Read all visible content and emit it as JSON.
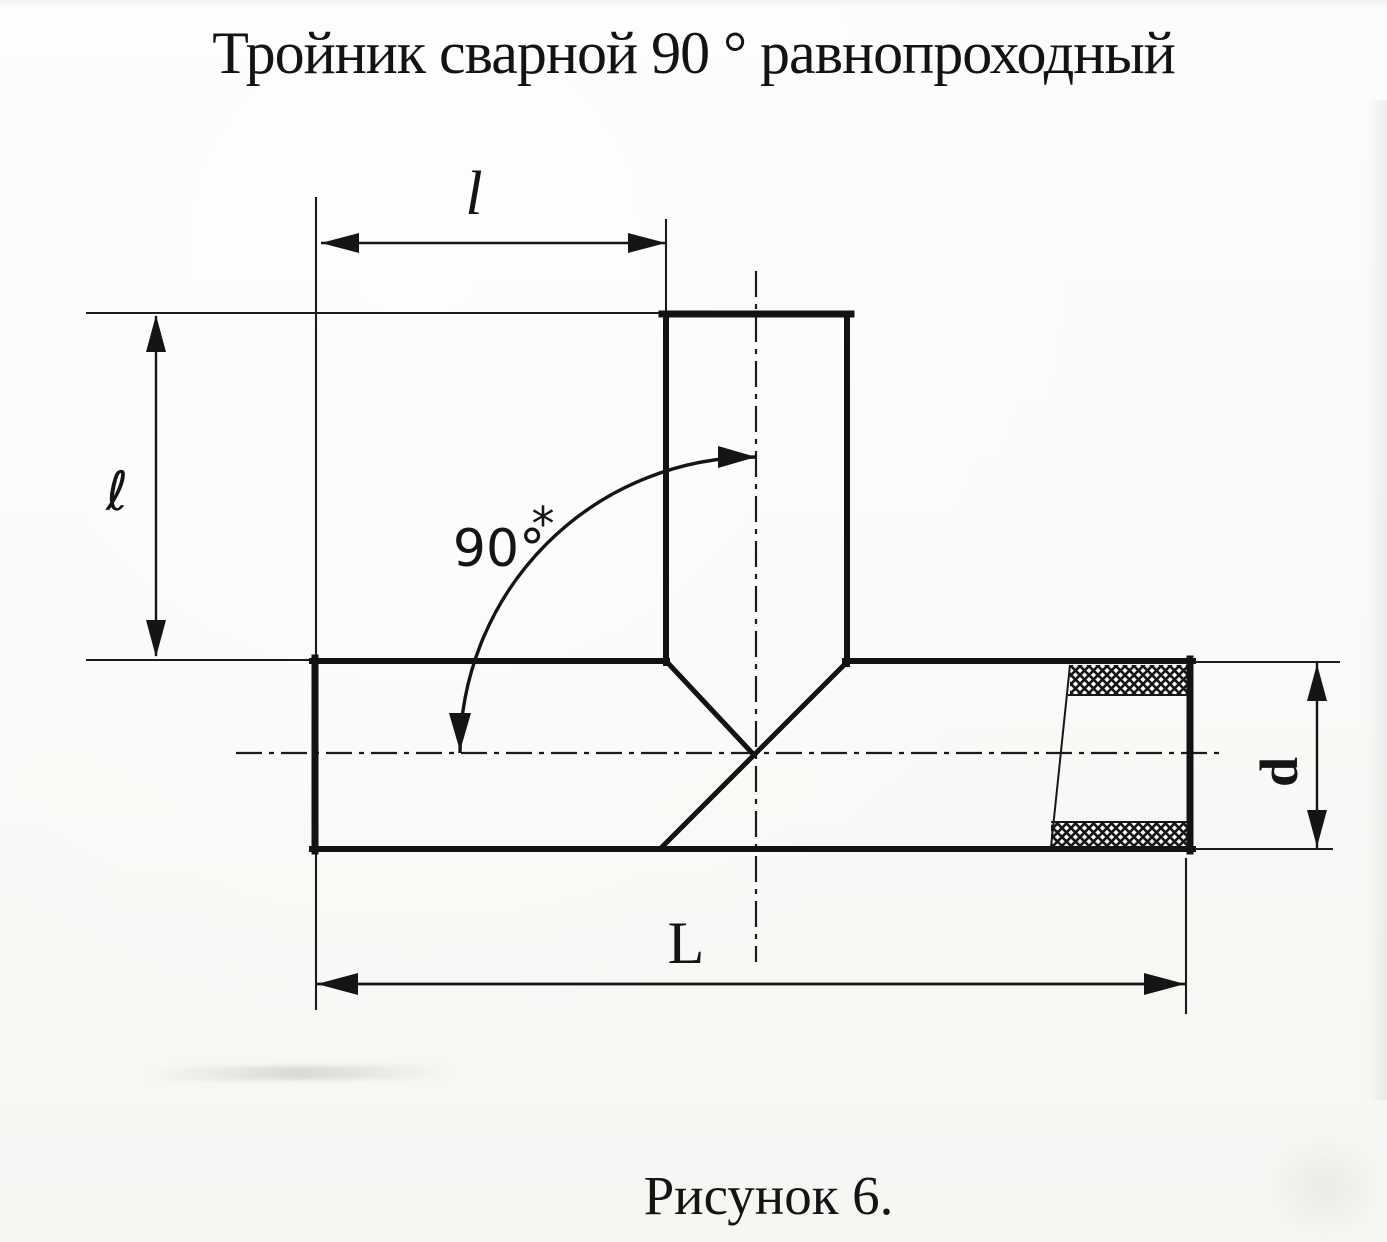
{
  "title": "Тройник сварной 90 ° равнопроходный",
  "caption": "Рисунок 6.",
  "labels": {
    "top_length": "l",
    "side_length": "ℓ",
    "angle": "90°",
    "angle_note": "*",
    "diameter": "d",
    "overall_length": "L"
  },
  "colors": {
    "ink": "#151515",
    "paper": "#fbfbf9"
  }
}
